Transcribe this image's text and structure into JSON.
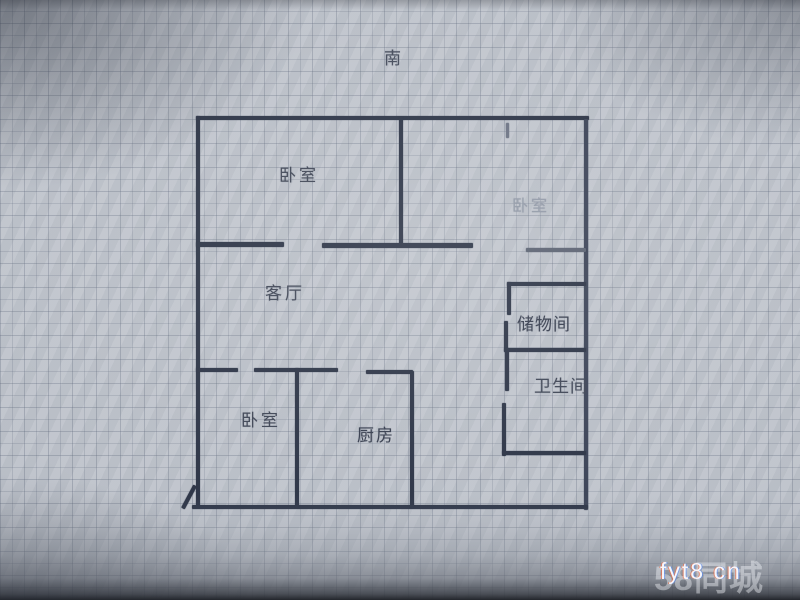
{
  "meta": {
    "width": 800,
    "height": 600
  },
  "compass": {
    "label": "南"
  },
  "floorplan": {
    "wall_color": "#2b3345",
    "rooms": [
      {
        "name": "bedroom-top-left",
        "text": "卧室",
        "x": 279,
        "y": 167,
        "size": 17,
        "color": "#3d4454",
        "spacing": 3
      },
      {
        "name": "bedroom-top-right",
        "text": "卧室",
        "x": 512,
        "y": 198,
        "size": 16,
        "color": "#9098a6",
        "spacing": 3
      },
      {
        "name": "living-room",
        "text": "客厅",
        "x": 265,
        "y": 285,
        "size": 17,
        "color": "#3d4454",
        "spacing": 3
      },
      {
        "name": "storage-room",
        "text": "储物间",
        "x": 517,
        "y": 316,
        "size": 17,
        "color": "#343b4c",
        "spacing": 1
      },
      {
        "name": "bathroom",
        "text": "卫生间",
        "x": 534,
        "y": 378,
        "size": 17,
        "color": "#3d4454",
        "spacing": 1
      },
      {
        "name": "bedroom-bottom-left",
        "text": "卧室",
        "x": 241,
        "y": 412,
        "size": 17,
        "color": "#3d4454",
        "spacing": 3
      },
      {
        "name": "kitchen",
        "text": "厨房",
        "x": 357,
        "y": 427,
        "size": 17,
        "color": "#343b4c",
        "spacing": 2
      }
    ],
    "walls": [
      {
        "x": 196,
        "y": 116,
        "w": 393,
        "h": 4
      },
      {
        "x": 196,
        "y": 116,
        "w": 4,
        "h": 392
      },
      {
        "x": 584,
        "y": 119,
        "w": 4,
        "h": 391,
        "c": "#3a4256"
      },
      {
        "x": 192,
        "y": 505,
        "w": 396,
        "h": 4
      },
      {
        "x": 187,
        "y": 484,
        "w": 4,
        "h": 26,
        "r": 28
      },
      {
        "x": 399,
        "y": 117,
        "w": 4,
        "h": 130
      },
      {
        "x": 506,
        "y": 123,
        "w": 3,
        "h": 15,
        "c": "#6a7182"
      },
      {
        "x": 196,
        "y": 242,
        "w": 88,
        "h": 5
      },
      {
        "x": 322,
        "y": 243,
        "w": 151,
        "h": 5
      },
      {
        "x": 526,
        "y": 248,
        "w": 60,
        "h": 4,
        "c": "#596070"
      },
      {
        "x": 507,
        "y": 282,
        "w": 79,
        "h": 4
      },
      {
        "x": 507,
        "y": 282,
        "w": 4,
        "h": 33
      },
      {
        "x": 504,
        "y": 321,
        "w": 4,
        "h": 31
      },
      {
        "x": 504,
        "y": 348,
        "w": 82,
        "h": 4
      },
      {
        "x": 505,
        "y": 348,
        "w": 4,
        "h": 43
      },
      {
        "x": 502,
        "y": 403,
        "w": 4,
        "h": 53
      },
      {
        "x": 502,
        "y": 451,
        "w": 84,
        "h": 4
      },
      {
        "x": 196,
        "y": 368,
        "w": 42,
        "h": 4
      },
      {
        "x": 254,
        "y": 368,
        "w": 84,
        "h": 4
      },
      {
        "x": 366,
        "y": 370,
        "w": 47,
        "h": 4
      },
      {
        "x": 295,
        "y": 368,
        "w": 4,
        "h": 140
      },
      {
        "x": 410,
        "y": 371,
        "w": 4,
        "h": 137
      }
    ]
  },
  "watermark": {
    "logo": "58同城",
    "text": "fyt8 cn"
  }
}
